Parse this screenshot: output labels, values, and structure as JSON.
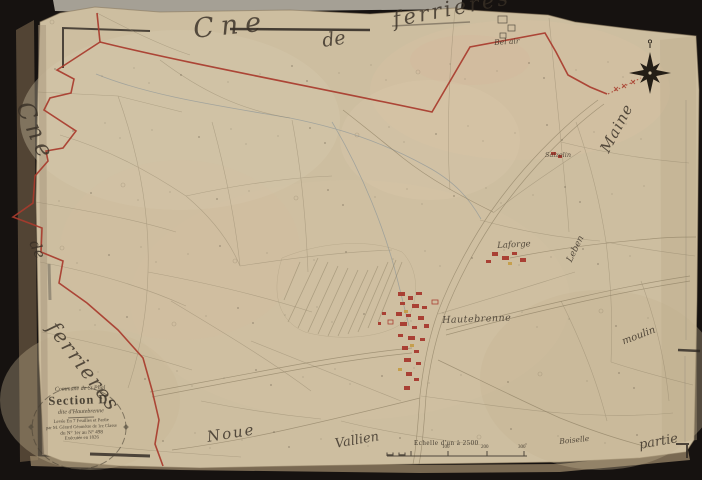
{
  "map_sheet": {
    "commune_top": {
      "word1": "Cne",
      "word2": "de",
      "word3": "ferrieres"
    },
    "commune_left": {
      "word1": "Cne",
      "word2": "de",
      "word3": "ferrieres"
    },
    "neighbors": {
      "right_upper": "Maine",
      "right_mid": "Leben",
      "right_lower": "moulin",
      "bottom_left": "Noue",
      "bottom_center": "Vallien",
      "bottom_small": "Boiselle",
      "bottom_right": "partie"
    },
    "places": {
      "bel_air": "Bel air",
      "saizelin": "Saizelin",
      "laforge": "Laforge",
      "hautebrenne": "Hautebrenne"
    },
    "cartouche": {
      "line1": "Commune de St Phal",
      "title": "Section D.",
      "subtitle": "dite d'Hautebrenne",
      "line4": "Levée En 7 Feuilles et Partie",
      "line5": "par M. Gérard Géomètre de 1re Classe",
      "line6": "du N° 1er au N° 498",
      "line7": "Exécutée en 1826"
    },
    "scale": {
      "label": "Echelle d'un à 2500",
      "ticks": [
        "100",
        "200",
        "300"
      ]
    },
    "icons": {
      "compass": "compass-rose"
    },
    "colors": {
      "boundary_red": "#a83b2c",
      "paper": "#cfc0a1",
      "building_red": "#a94034",
      "ink": "#3a332a"
    }
  }
}
